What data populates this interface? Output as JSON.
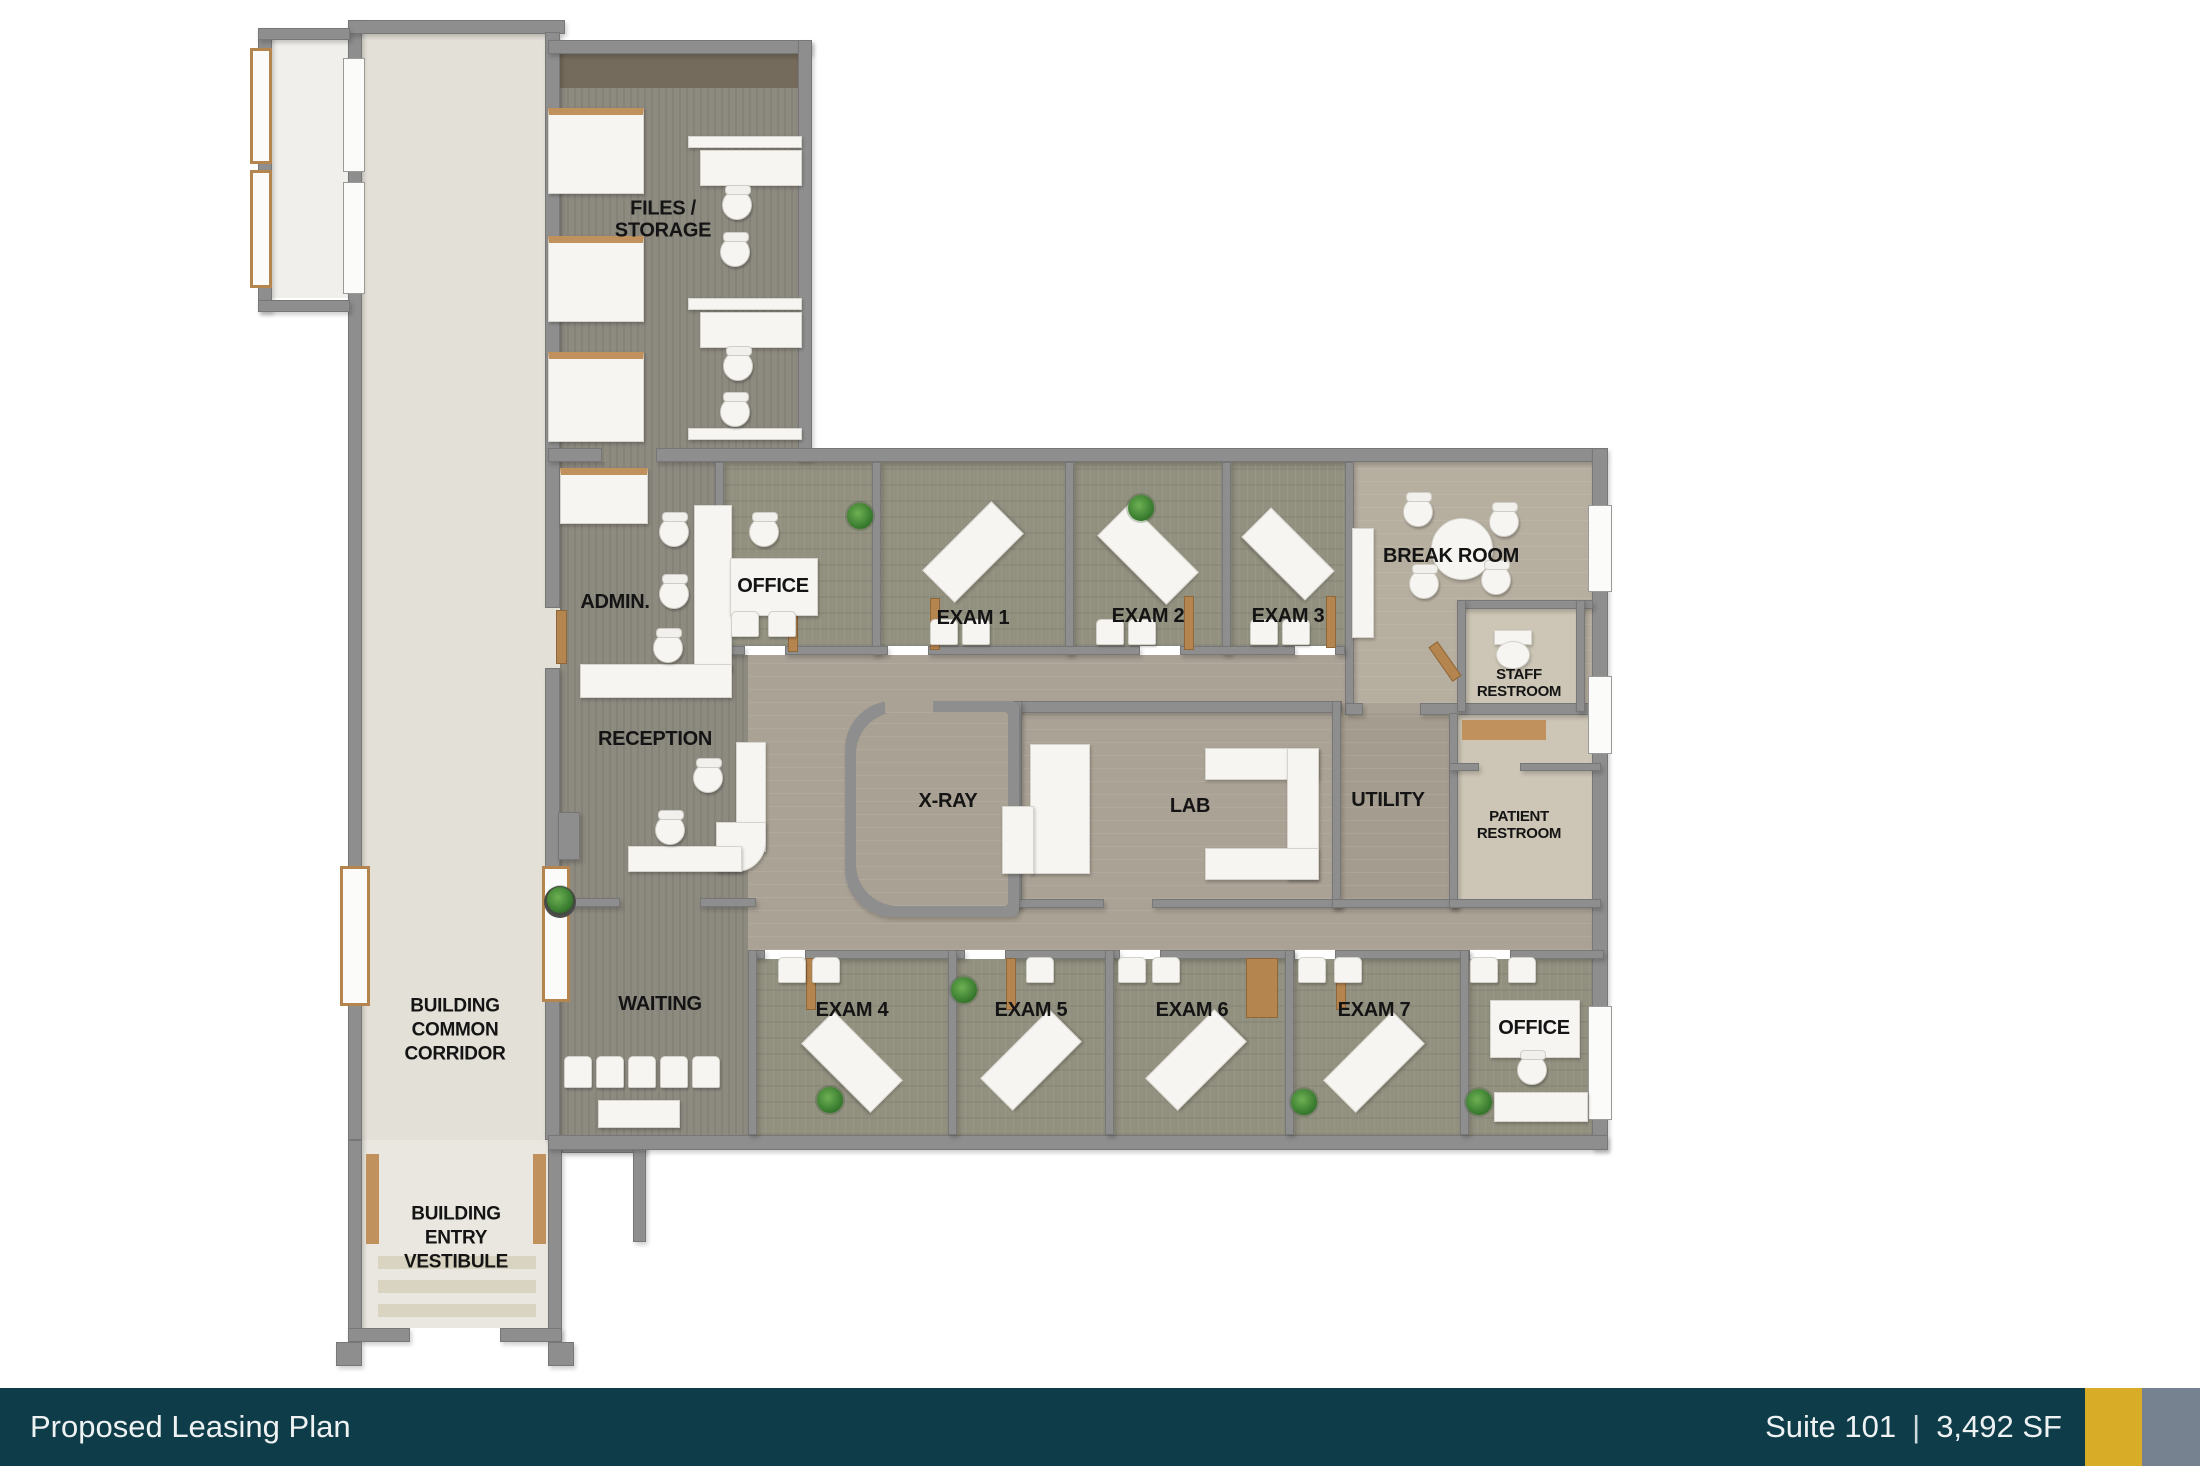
{
  "footer": {
    "title": "Proposed Leasing Plan",
    "suite": "Suite 101",
    "separator": "|",
    "area": "3,492 SF",
    "bar_color": "#0e3c49",
    "text_color": "#eef2f3",
    "accent_gold": "#d9ac28",
    "accent_gray": "#76828f"
  },
  "rooms": {
    "files_storage": {
      "label": "FILES /\nSTORAGE"
    },
    "admin": {
      "label": "ADMIN."
    },
    "office_top": {
      "label": "OFFICE"
    },
    "exam1": {
      "label": "EXAM 1"
    },
    "exam2": {
      "label": "EXAM 2"
    },
    "exam3": {
      "label": "EXAM 3"
    },
    "break_room": {
      "label": "BREAK ROOM"
    },
    "staff_restroom": {
      "label": "STAFF\nRESTROOM"
    },
    "reception": {
      "label": "RECEPTION"
    },
    "xray": {
      "label": "X-RAY"
    },
    "lab": {
      "label": "LAB"
    },
    "utility": {
      "label": "UTILITY"
    },
    "patient_restroom": {
      "label": "PATIENT\nRESTROOM"
    },
    "waiting": {
      "label": "WAITING"
    },
    "exam4": {
      "label": "EXAM 4"
    },
    "exam5": {
      "label": "EXAM 5"
    },
    "exam6": {
      "label": "EXAM 6"
    },
    "exam7": {
      "label": "EXAM 7"
    },
    "office_bottom": {
      "label": "OFFICE"
    },
    "common_corridor": {
      "label": "BUILDING\nCOMMON\nCORRIDOR"
    },
    "entry_vestibule": {
      "label": "BUILDING\nENTRY\nVESTIBULE"
    }
  }
}
